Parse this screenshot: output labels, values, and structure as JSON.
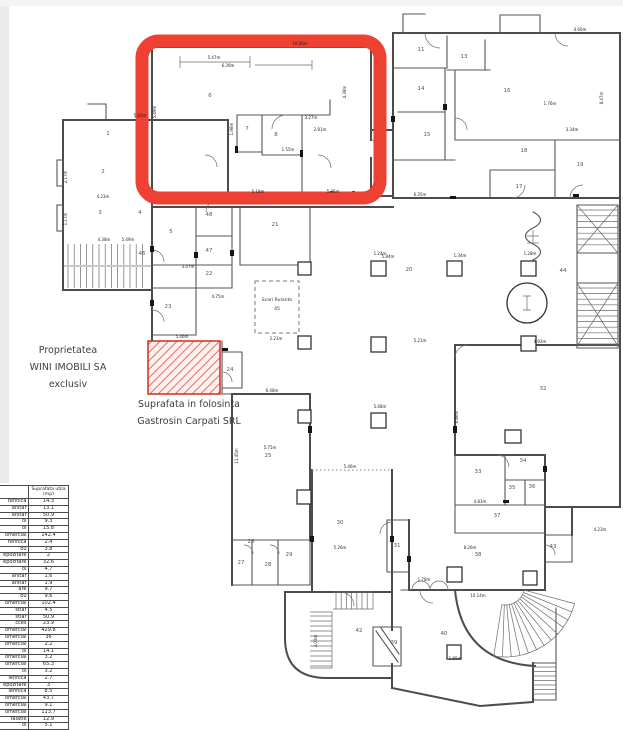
{
  "colors": {
    "highlight": "#ee4133",
    "hatch_line": "#e2574c",
    "hatch_fill": "#fdf1f0",
    "hatch_border": "#cf3a30",
    "wall": "#4c4c4c"
  },
  "annotations": {
    "ownership": [
      "Proprietatea",
      "WINI IMOBILI SA",
      "exclusiv"
    ],
    "usage": [
      "Suprafata in folosinta",
      "Gastrosin Carpati SRL"
    ],
    "escalator_label": "Scari Rulante",
    "escalator_room": "45"
  },
  "plan": {
    "rooms": [
      {
        "n": "1",
        "x": 108,
        "y": 135
      },
      {
        "n": "2",
        "x": 103,
        "y": 173
      },
      {
        "n": "3",
        "x": 100,
        "y": 214
      },
      {
        "n": "4",
        "x": 140,
        "y": 214
      },
      {
        "n": "5",
        "x": 171,
        "y": 233
      },
      {
        "n": "6",
        "x": 210,
        "y": 97
      },
      {
        "n": "7",
        "x": 247,
        "y": 130
      },
      {
        "n": "8",
        "x": 276,
        "y": 136
      },
      {
        "n": "11",
        "x": 421,
        "y": 51
      },
      {
        "n": "13",
        "x": 464,
        "y": 58
      },
      {
        "n": "14",
        "x": 421,
        "y": 90
      },
      {
        "n": "15",
        "x": 427,
        "y": 136
      },
      {
        "n": "16",
        "x": 507,
        "y": 92
      },
      {
        "n": "17",
        "x": 519,
        "y": 188
      },
      {
        "n": "18",
        "x": 524,
        "y": 152
      },
      {
        "n": "19",
        "x": 580,
        "y": 166
      },
      {
        "n": "20",
        "x": 409,
        "y": 271
      },
      {
        "n": "21",
        "x": 275,
        "y": 226
      },
      {
        "n": "22",
        "x": 209,
        "y": 275
      },
      {
        "n": "23",
        "x": 168,
        "y": 308
      },
      {
        "n": "24",
        "x": 230,
        "y": 371
      },
      {
        "n": "25",
        "x": 268,
        "y": 457
      },
      {
        "n": "26",
        "x": 251,
        "y": 543
      },
      {
        "n": "27",
        "x": 241,
        "y": 564
      },
      {
        "n": "28",
        "x": 268,
        "y": 566
      },
      {
        "n": "29",
        "x": 289,
        "y": 556
      },
      {
        "n": "30",
        "x": 340,
        "y": 524
      },
      {
        "n": "31",
        "x": 397,
        "y": 547
      },
      {
        "n": "32",
        "x": 543,
        "y": 390
      },
      {
        "n": "33",
        "x": 478,
        "y": 473
      },
      {
        "n": "34",
        "x": 523,
        "y": 462
      },
      {
        "n": "35",
        "x": 512,
        "y": 489
      },
      {
        "n": "36",
        "x": 532,
        "y": 488
      },
      {
        "n": "37",
        "x": 497,
        "y": 517
      },
      {
        "n": "38",
        "x": 478,
        "y": 556
      },
      {
        "n": "39",
        "x": 394,
        "y": 644
      },
      {
        "n": "40",
        "x": 444,
        "y": 635
      },
      {
        "n": "42",
        "x": 359,
        "y": 632
      },
      {
        "n": "43",
        "x": 553,
        "y": 548
      },
      {
        "n": "44",
        "x": 563,
        "y": 272
      },
      {
        "n": "46",
        "x": 142,
        "y": 255
      },
      {
        "n": "47",
        "x": 209,
        "y": 252
      },
      {
        "n": "48",
        "x": 209,
        "y": 216
      }
    ],
    "dimensions": [
      {
        "t": "5.47m",
        "x": 214,
        "y": 59,
        "r": 0
      },
      {
        "t": "6.39m",
        "x": 228,
        "y": 67,
        "r": 0
      },
      {
        "t": "5.49m",
        "x": 156,
        "y": 112,
        "r": -90
      },
      {
        "t": "1.98m",
        "x": 233,
        "y": 129,
        "r": -90
      },
      {
        "t": "3.27m",
        "x": 311,
        "y": 119,
        "r": 0
      },
      {
        "t": "2.81m",
        "x": 320,
        "y": 131,
        "r": 0
      },
      {
        "t": "1.55m",
        "x": 288,
        "y": 151,
        "r": 0
      },
      {
        "t": "5.18m",
        "x": 258,
        "y": 193,
        "r": 0
      },
      {
        "t": "5.26m",
        "x": 333,
        "y": 193,
        "r": 0
      },
      {
        "t": "4.38m",
        "x": 346,
        "y": 92,
        "r": -90
      },
      {
        "t": "10.06m",
        "x": 300,
        "y": 45,
        "r": 0
      },
      {
        "t": "4.66m",
        "x": 580,
        "y": 31,
        "r": 0
      },
      {
        "t": "1.76m",
        "x": 550,
        "y": 105,
        "r": 0
      },
      {
        "t": "8.47m",
        "x": 603,
        "y": 98,
        "r": -90
      },
      {
        "t": "3.34m",
        "x": 572,
        "y": 131,
        "r": 0
      },
      {
        "t": "6.35m",
        "x": 420,
        "y": 196,
        "r": 0
      },
      {
        "t": "4.23m",
        "x": 103,
        "y": 198,
        "r": 0
      },
      {
        "t": "5.83m",
        "x": 140,
        "y": 117,
        "r": 0
      },
      {
        "t": "2.17m",
        "x": 67,
        "y": 177,
        "r": -90
      },
      {
        "t": "1.17m",
        "x": 67,
        "y": 219,
        "r": -90
      },
      {
        "t": "4.38m",
        "x": 104,
        "y": 241,
        "r": 0
      },
      {
        "t": "5.49m",
        "x": 128,
        "y": 241,
        "r": 0
      },
      {
        "t": "3.47m",
        "x": 188,
        "y": 268,
        "r": 0
      },
      {
        "t": "4.75m",
        "x": 218,
        "y": 298,
        "r": 0
      },
      {
        "t": "2.21m",
        "x": 276,
        "y": 340,
        "r": 0
      },
      {
        "t": "5.46m",
        "x": 182,
        "y": 338,
        "r": 0
      },
      {
        "t": "6.48m",
        "x": 272,
        "y": 392,
        "r": 0
      },
      {
        "t": "11.45m",
        "x": 238,
        "y": 456,
        "r": -90
      },
      {
        "t": "5.75m",
        "x": 270,
        "y": 449,
        "r": 0
      },
      {
        "t": "5.46m",
        "x": 350,
        "y": 468,
        "r": 0
      },
      {
        "t": "5.26m",
        "x": 340,
        "y": 549,
        "r": 0
      },
      {
        "t": "4.03m",
        "x": 317,
        "y": 641,
        "r": -90
      },
      {
        "t": "1.34m",
        "x": 460,
        "y": 257,
        "r": 0
      },
      {
        "t": "5.84m",
        "x": 388,
        "y": 258,
        "r": 0
      },
      {
        "t": "4.93m",
        "x": 540,
        "y": 343,
        "r": 0
      },
      {
        "t": "6.86m",
        "x": 458,
        "y": 417,
        "r": -90
      },
      {
        "t": "4.83m",
        "x": 480,
        "y": 503,
        "r": 0
      },
      {
        "t": "8.26m",
        "x": 470,
        "y": 549,
        "r": 0
      },
      {
        "t": "4.23m",
        "x": 600,
        "y": 531,
        "r": 0
      },
      {
        "t": "10.14m",
        "x": 478,
        "y": 597,
        "r": 0
      },
      {
        "t": "1.78m",
        "x": 424,
        "y": 581,
        "r": 0
      },
      {
        "t": "5.21m",
        "x": 420,
        "y": 342,
        "r": 0
      },
      {
        "t": "1.24m",
        "x": 380,
        "y": 255,
        "r": 0
      },
      {
        "t": "1.28m",
        "x": 530,
        "y": 255,
        "r": 0
      },
      {
        "t": "5.68m",
        "x": 380,
        "y": 408,
        "r": 0
      },
      {
        "t": "1.85m",
        "x": 455,
        "y": 660,
        "r": 0
      }
    ]
  },
  "table": {
    "header_col1_lines": [
      "re",
      "ie"
    ],
    "header_col2_lines": [
      "Suprafata utila",
      "(mp)"
    ],
    "rows": [
      {
        "label": "tehnica",
        "value": "14.3"
      },
      {
        "label": "anitar",
        "value": "13.1"
      },
      {
        "label": "anitar",
        "value": "50.9"
      },
      {
        "label": "ol",
        "value": "9.3"
      },
      {
        "label": "ol",
        "value": "15.8"
      },
      {
        "label": "omercial",
        "value": "142.4"
      },
      {
        "label": "tehnica",
        "value": "2.4"
      },
      {
        "label": "ou",
        "value": "3.8"
      },
      {
        "label": "epozitare",
        "value": "2"
      },
      {
        "label": "epozitare",
        "value": "32.6"
      },
      {
        "label": "ol",
        "value": "4.7"
      },
      {
        "label": "anitar",
        "value": "1.6"
      },
      {
        "label": "anitar",
        "value": "1.9"
      },
      {
        "label": "are",
        "value": "9.7"
      },
      {
        "label": "ou",
        "value": "9.6"
      },
      {
        "label": "omercial",
        "value": "102.4"
      },
      {
        "label": "stiar",
        "value": "4.5"
      },
      {
        "label": "stiar",
        "value": "50.9"
      },
      {
        "label": "cces",
        "value": "23.9"
      },
      {
        "label": "omercial",
        "value": "429.8"
      },
      {
        "label": "omercial",
        "value": "36"
      },
      {
        "label": "omercial",
        "value": "2.2"
      },
      {
        "label": "ol",
        "value": "14.1"
      },
      {
        "label": "omercial",
        "value": "3.2"
      },
      {
        "label": "omercial",
        "value": "65.3"
      },
      {
        "label": "ol",
        "value": "3.2"
      },
      {
        "label": "Tehnica",
        "value": "2.7"
      },
      {
        "label": "epozitare",
        "value": "3"
      },
      {
        "label": "Tehnica",
        "value": "8.5"
      },
      {
        "label": "omercial",
        "value": "43.7"
      },
      {
        "label": "omercial",
        "value": "9.1"
      },
      {
        "label": "omercial",
        "value": "113.7"
      },
      {
        "label": "talatie",
        "value": "12.9"
      },
      {
        "label": "ol",
        "value": "5.1"
      }
    ],
    "thick_after": [
      4,
      13,
      21
    ]
  }
}
